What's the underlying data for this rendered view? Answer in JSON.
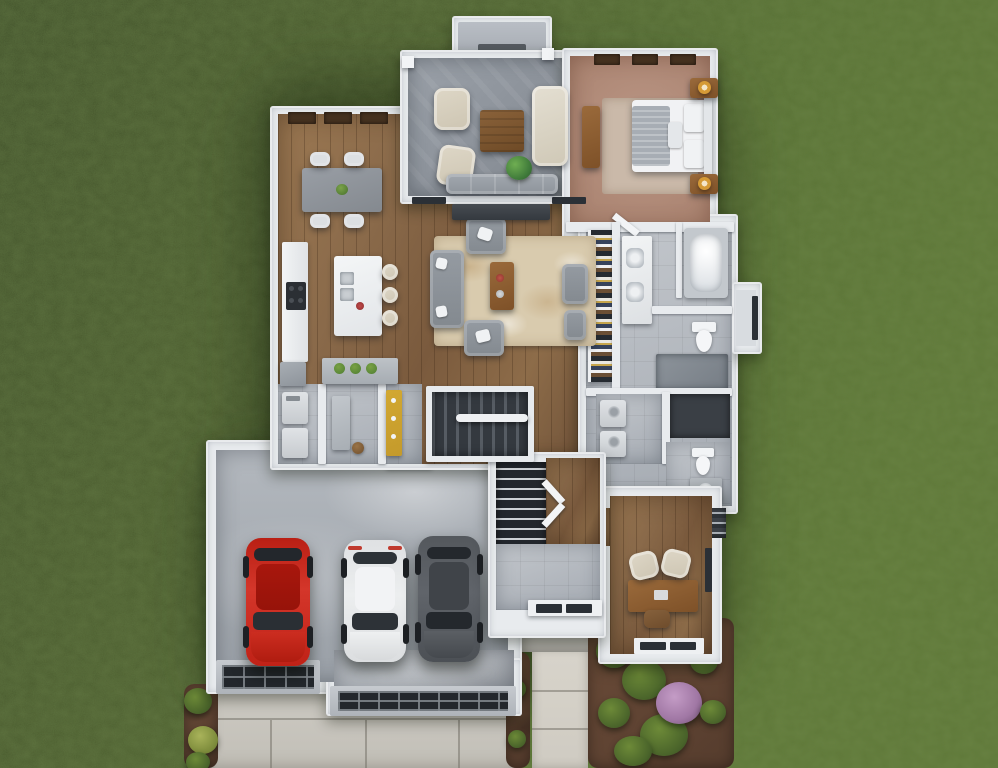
{
  "scene": {
    "type": "3d-rendered-floor-plan",
    "view": "top-down-aerial",
    "description": "Photorealistic top-down 3D rendering of a single-story house floor plan surrounded by lawn, with screened porch, open living-dining-kitchen area, master suite with walk-in closet and bath, laundry, office, foyer, stairwell, and a three-car garage with driveway and landscaped beds",
    "canvas": {
      "width": 998,
      "height": 768
    }
  },
  "colors": {
    "grassDark": "#3e4b27",
    "grassMid": "#4c5c2e",
    "grassLight": "#5e7434",
    "wall": "#e8ebee",
    "wallShade": "#c6ccd3",
    "windowHeader": "#45311f",
    "glass": "#2b3036",
    "wood": "#8a6a4a",
    "porch": "#8f959d",
    "tileGray": "#b8bcc1",
    "carpet": "#b28e7e",
    "rugCream": "#d9cbae",
    "bedRug": "#cab9a9",
    "driveway": "#c9c6bf",
    "walkway": "#d6d2c9",
    "stoop": "#b7b5b0",
    "mulch": "#5d4334",
    "shrub": "#49632a",
    "shrubLight": "#6d8a38",
    "flower": "#a077a4",
    "stairDark": "#343a40",
    "accentYellow": "#c49a2b",
    "island": "#f0f2f4",
    "sofaGray": "#8b9198",
    "creamChair": "#d6cfc0",
    "furnitureWood": "#8a5c32",
    "lamp": "#d59a36",
    "bedWhite": "#f1f2f4",
    "blanketGray": "#a7adb4",
    "carRed": "#c1251a",
    "carWhite": "#e9ebec",
    "carGray": "#565b60"
  },
  "inventory": {
    "cars": [
      {
        "color_name": "red"
      },
      {
        "color_name": "white"
      },
      {
        "color_name": "dark-gray"
      }
    ],
    "rooms": [
      "screened-porch",
      "dining-area",
      "kitchen",
      "living-room",
      "master-bedroom",
      "walk-in-closet",
      "master-bathroom",
      "laundry-room",
      "mudroom",
      "stairwell",
      "hallway",
      "half-bathroom",
      "linen-closet",
      "coat-closet",
      "foyer",
      "office",
      "three-car-garage"
    ],
    "furniture_counts": {
      "dining_chairs": 4,
      "kitchen_stools": 3,
      "porch_chairs": 2,
      "living_armchairs": 3,
      "office_guest_chairs": 2,
      "vanity_sinks": 2,
      "garage_doors": 2
    },
    "landscaping": [
      "front-garden-bed-with-purple-flowers",
      "driveway-side-bed",
      "walkway-border-bed"
    ]
  }
}
